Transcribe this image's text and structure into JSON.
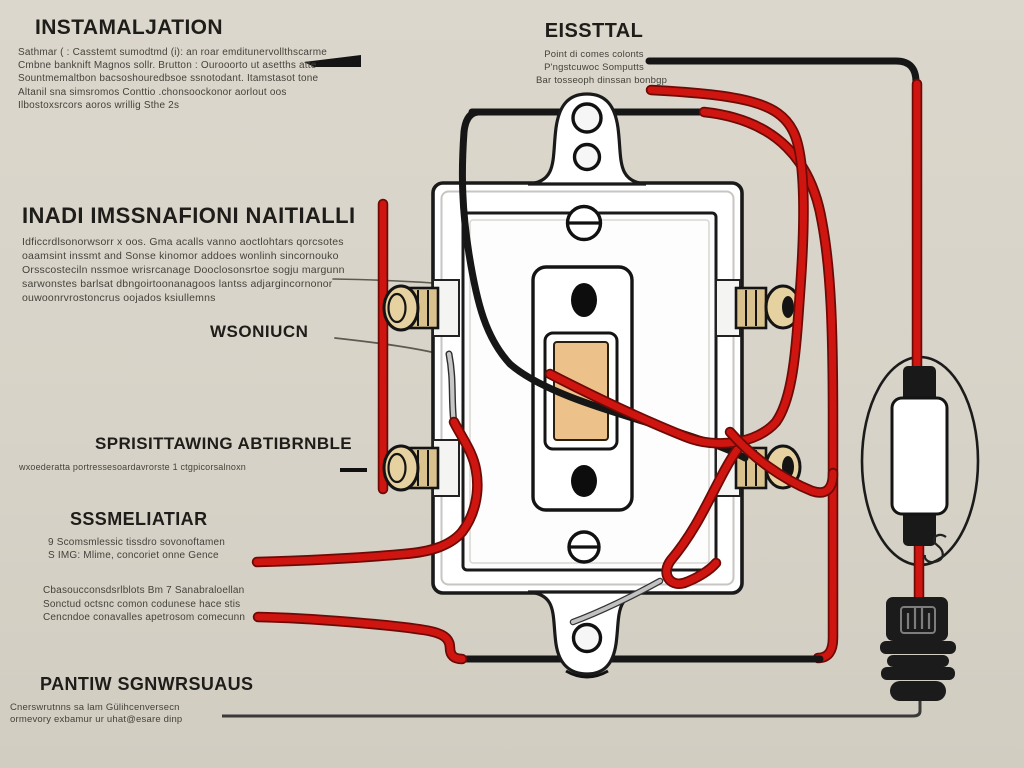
{
  "colors": {
    "background": "#d7d3c8",
    "wire_red": "#ce1510",
    "wire_black": "#161616",
    "brass_terminal": "#e6d2a0",
    "toggle_tan": "#ecc28a",
    "plate_white": "#ffffff"
  },
  "labels": {
    "installation": {
      "title": "INSTAMALJATION",
      "lines": [
        "Sathmar ( : Casstemt sumodtmd (i): an roar emditunervollthscarme",
        "Cmbne banknift Magnos sollr. Brutton : Ourooorto ut asetths atte",
        "Sountmemaltbon bacsoshouredbsoe ssnotodant. Itamstasot tone",
        "Altanil sna simsromos   Conttio .chonsoockonor aorlout oos",
        "Ilbostoxsrcors aoros wrillig Sthe  2s"
      ]
    },
    "esstal": {
      "title": "EISSTTAL",
      "lines": [
        "Point di comes colonts",
        "P'ngstcuwoc Somputts",
        "Bar tosseoph dinssan bonbgp"
      ]
    },
    "inadi": {
      "title": "INADI IMSSNAFIONI NAITIALLI",
      "lines": [
        "Idficcrdlsonorwsorr x oos. Gma  acalls vanno aoctlohtars qorcsotes",
        "oaamsint inssmt and Sonse kinomor addoes wonlinh sincornouko",
        "Orsscosteciln nssmoe wrisrcanage Dooclosonsrtoe sogju margunn",
        "sarwonstes barlsat dbngoirtoonanagoos lantss adjargincornonor",
        "ouwoonrvrostoncrus oojados ksiullemns"
      ]
    },
    "wsoniucn": {
      "title": "WSONIUCN"
    },
    "sprisittawing": {
      "title": "SPRISITTAWING ABTIBRNBLE",
      "lines": [
        "wxoederatta portressesoardavrorste 1 ctgpicorsalnoxn"
      ]
    },
    "sssmeliatiar": {
      "title": "SSSMELIATIAR",
      "lines": [
        "9 Scomsmlessic tissdro sovonoftamen",
        "S IMG: Mlime, concoriet onne Gence"
      ]
    },
    "midnote": {
      "lines": [
        "Cbasoucconsdsrlblots Bm 7 Sanabraloellan",
        "Sonctud octsnc  comon codunese  hace stis",
        "Cencndoe conavalles apetrosom comecunn"
      ]
    },
    "pantiw": {
      "title": "PANTIW SGNWRSUAUS",
      "lines": [
        "Cnerswrutnns sa lam Gülihcenversecn",
        "ormevory exbamur ur uhat@esare dinp"
      ]
    }
  }
}
